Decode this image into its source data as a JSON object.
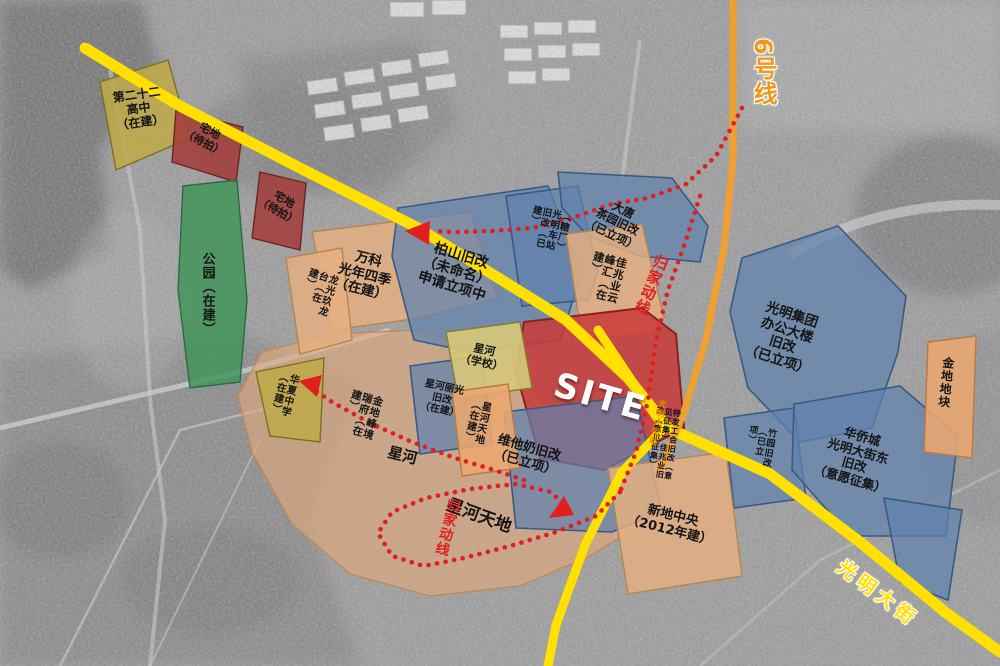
{
  "map": {
    "colors": {
      "road_yellow": "#FFE000",
      "metro_orange": "#F0A030",
      "route_red": "#E01F1F",
      "zone_blue": "#6082AF",
      "zone_tan": "#E7B080",
      "zone_green": "#409458",
      "zone_site_red": "#C93A3A"
    },
    "roads": [
      {
        "id": "main-road-west",
        "points": "85,48 180,106 300,168 418,228 492,274 566,320 628,378 668,428",
        "width": 11,
        "color": "#FFE000"
      },
      {
        "id": "guangming-street",
        "points": "668,428 770,474 860,542 945,612 1000,652",
        "width": 11,
        "color": "#FFE000"
      },
      {
        "id": "cross-road-south",
        "points": "598,330 642,396 664,428 622,472 585,545 556,625 548,666",
        "width": 9,
        "color": "#FFE000"
      }
    ],
    "metro": {
      "id": "metro-line-6",
      "points": "733,0 733,160 724,248 706,340 684,412 660,470",
      "width": 7,
      "color": "#F0A030"
    },
    "routes": [
      {
        "id": "route-home-top",
        "points": "742,108 716,156 686,184 648,198 612,204 572,218 532,228 492,231 455,232 432,231"
      },
      {
        "id": "route-home-side",
        "points": "700,196 686,240 668,290 655,345 648,400 636,452 620,492"
      },
      {
        "id": "route-home-loop",
        "points": "620,492 596,516 556,532 510,546 464,558 424,566 392,556 378,533 392,512 426,498 470,489 516,484 551,492 562,503"
      },
      {
        "id": "route-home-school",
        "points": "524,480 494,470 455,458 412,442 372,424 332,402 312,388"
      }
    ],
    "arrows": [
      {
        "id": "arrow-main-road",
        "points": "430,221 405,231 429,245"
      },
      {
        "id": "arrow-huaxia",
        "points": "322,375 299,381 317,397"
      },
      {
        "id": "arrow-weitanai",
        "points": "549,518 564,496 574,515"
      }
    ],
    "zones": [
      {
        "id": "tan-mass",
        "type": "z-tanbig",
        "points": "262,352 330,334 420,330 470,348 520,380 560,420 600,452 640,472 648,520 590,556 520,586 430,596 350,574 292,524 252,452 238,396"
      },
      {
        "id": "school-22",
        "type": "z-olive",
        "points": "100,82 168,60 190,138 116,170",
        "label": {
          "text": [
            "第二十二",
            "高中",
            "（在建）"
          ],
          "x": 112,
          "y": 92,
          "rot": -8,
          "size": 12
        }
      },
      {
        "id": "zhaidi-1",
        "type": "z-maroon",
        "points": "176,110 243,127 236,182 172,162",
        "label": {
          "text": [
            "宅地",
            "（待拍）"
          ],
          "x": 193,
          "y": 116,
          "rot": 28,
          "size": 11
        }
      },
      {
        "id": "zhaidi-2",
        "type": "z-maroon",
        "points": "260,172 306,183 300,250 252,238",
        "label": {
          "text": [
            "宅地",
            "（待拍）"
          ],
          "x": 268,
          "y": 184,
          "rot": 30,
          "size": 11
        }
      },
      {
        "id": "park",
        "type": "z-green",
        "points": "183,186 237,180 247,300 240,382 190,388 178,290",
        "label": {
          "text": [
            "公园（在建）"
          ],
          "x": 200,
          "y": 252,
          "rot": 0,
          "size": 13,
          "mode": "v",
          "h": 120
        }
      },
      {
        "id": "wanke",
        "type": "z-tan",
        "points": "312,232 470,212 498,298 420,318 332,330",
        "label": {
          "text": [
            "万科",
            "光年四季",
            "（在建）"
          ],
          "x": 344,
          "y": 246,
          "rot": 14,
          "size": 13.5
        }
      },
      {
        "id": "longguang",
        "type": "z-tan",
        "points": "286,258 342,248 352,340 300,354",
        "label": {
          "text": [
            "龙光玖龙台（在建）"
          ],
          "x": 308,
          "y": 266,
          "rot": 18,
          "size": 10,
          "mode": "v",
          "h": 46
        }
      },
      {
        "id": "baishan",
        "type": "z-blue",
        "points": "398,208 548,186 582,272 560,340 470,352 414,340 392,256",
        "label": {
          "text": [
            "柏山旧改",
            "（未命名）",
            "申请立项中"
          ],
          "x": 430,
          "y": 238,
          "rot": 17,
          "size": 14
        }
      },
      {
        "id": "tangchang",
        "type": "z-blue",
        "points": "506,196 578,186 598,272 588,300 522,306",
        "label": {
          "text": [
            "（糖厂）光明车站旧改（已建）"
          ],
          "x": 532,
          "y": 204,
          "rot": 12,
          "size": 9.5,
          "mode": "v",
          "h": 46
        }
      },
      {
        "id": "datang",
        "type": "z-blue",
        "points": "558,172 672,178 708,226 700,262 640,256 588,236 562,208",
        "label": {
          "text": [
            "大唐",
            "茶园旧改",
            "（已立项）"
          ],
          "x": 600,
          "y": 192,
          "rot": 26,
          "size": 11.5
        }
      },
      {
        "id": "jiazhaoye",
        "type": "z-tan",
        "points": "566,234 642,224 664,318 652,334 582,338",
        "label": {
          "text": [
            "佳兆业云峰汇（在建）"
          ],
          "x": 594,
          "y": 250,
          "rot": 14,
          "size": 11,
          "mode": "v",
          "h": 48
        }
      },
      {
        "id": "guangming-group",
        "type": "z-blue",
        "points": "742,258 838,226 906,296 898,352 872,428 800,442 748,388 730,312",
        "label": {
          "text": [
            "光明集团",
            "办公大楼",
            "旧改",
            "（已立项）"
          ],
          "x": 762,
          "y": 298,
          "rot": 18,
          "size": 13.5
        }
      },
      {
        "id": "zhuyuan",
        "type": "z-blue",
        "points": "724,418 794,408 806,498 734,508",
        "label": {
          "text": [
            "竹园旧改（已立项）"
          ],
          "x": 748,
          "y": 424,
          "rot": 10,
          "size": 9,
          "mode": "v",
          "h": 42
        }
      },
      {
        "id": "huaqiaocheng",
        "type": "z-blue",
        "points": "794,404 900,386 958,436 946,536 850,536 792,470",
        "label": {
          "text": [
            "华侨城",
            "光明大街东",
            "旧改",
            "（意愿征集）"
          ],
          "x": 828,
          "y": 420,
          "rot": 16,
          "size": 12.5
        }
      },
      {
        "id": "huaqiaocheng-east",
        "type": "z-blue",
        "points": "884,498 962,510 948,600 900,582"
      },
      {
        "id": "jindi-dikuai",
        "type": "z-orgs",
        "points": "928,342 976,336 972,458 924,452",
        "label": {
          "text": [
            "金地地块"
          ],
          "x": 942,
          "y": 356,
          "rot": 6,
          "size": 12,
          "mode": "v",
          "h": 90
        }
      },
      {
        "id": "site",
        "type": "z-red",
        "points": "524,322 642,308 676,334 684,428 604,470 540,458 516,372",
        "label": {
          "text": [
            "SITE"
          ],
          "x": 560,
          "y": 366,
          "rot": 16,
          "size": 34,
          "color": "#ffffff",
          "cls": "site-t"
        }
      },
      {
        "id": "weitanai",
        "type": "z-blue",
        "points": "504,412 636,396 662,512 612,532 516,528",
        "label": {
          "text": [
            "维他奶旧改",
            "（已立项）"
          ],
          "x": 500,
          "y": 432,
          "rot": 16,
          "size": 13
        }
      },
      {
        "id": "xinghe-liguang",
        "type": "z-blue",
        "points": "410,366 482,356 492,444 420,454",
        "label": {
          "text": [
            "星河丽光",
            "旧改",
            "（在建）"
          ],
          "x": 426,
          "y": 378,
          "rot": 12,
          "size": 10
        }
      },
      {
        "id": "xinghe-school",
        "type": "z-khaki",
        "points": "446,332 520,322 532,388 458,398",
        "label": {
          "text": [
            "星河",
            "（学校）"
          ],
          "x": 464,
          "y": 340,
          "rot": 12,
          "size": 11
        }
      },
      {
        "id": "xinghe-tiandi-blk",
        "type": "z-orgs",
        "points": "452,392 508,384 520,468 462,476",
        "label": {
          "text": [
            "星河天地（在建）"
          ],
          "x": 470,
          "y": 398,
          "rot": 12,
          "size": 10,
          "mode": "v",
          "h": 44
        }
      },
      {
        "id": "huaxia",
        "type": "z-olive",
        "points": "256,372 324,358 320,442 270,436",
        "label": {
          "text": [
            "华夏中学（在建）"
          ],
          "x": 278,
          "y": 370,
          "rot": 14,
          "size": 10,
          "mode": "v",
          "h": 44
        }
      },
      {
        "id": "xindi-zhongyang",
        "type": "z-tan",
        "points": "608,468 726,452 742,576 628,594",
        "label": {
          "text": [
            "新地中央",
            "（2012年建）"
          ],
          "x": 632,
          "y": 498,
          "rot": 14,
          "size": 13
        }
      }
    ],
    "labels": [
      {
        "id": "jindi-fengjing",
        "text": [
          "金地峰境瑞府（在建）"
        ],
        "x": 352,
        "y": 388,
        "rot": 16,
        "size": 10.5,
        "mode": "v",
        "h": 48
      },
      {
        "id": "xinghe-big",
        "text": [
          "星河"
        ],
        "x": 390,
        "y": 444,
        "rot": 14,
        "size": 15
      },
      {
        "id": "xinghe-tiandi-big",
        "text": [
          "星河天地"
        ],
        "x": 450,
        "y": 496,
        "rot": 20,
        "size": 17
      },
      {
        "id": "gonghui-tiny",
        "text": [
          "特发工会旧改（意见征集）佳兆业旧改（意见征集）"
        ],
        "x": 656,
        "y": 406,
        "rot": 8,
        "size": 8,
        "mode": "v",
        "h": 78,
        "color": "#101020"
      },
      {
        "id": "guijia-top",
        "text": [
          "归家动线"
        ],
        "x": 655,
        "y": 252,
        "rot": 22,
        "size": 15,
        "mode": "v",
        "h": 80,
        "color": "#E01F1F"
      },
      {
        "id": "guijia-bottom",
        "text": [
          "归家动线"
        ],
        "x": 447,
        "y": 496,
        "rot": 14,
        "size": 14,
        "mode": "v",
        "h": 76,
        "color": "#E01F1F"
      },
      {
        "id": "metro-line6-label",
        "text": [
          "6号线"
        ],
        "x": 750,
        "y": 38,
        "rot": 0,
        "size": 24,
        "mode": "v",
        "h": 120,
        "color": "#F09818",
        "cls": "outline-w"
      },
      {
        "id": "guangming-street-label",
        "text": [
          "光明大街"
        ],
        "x": 846,
        "y": 556,
        "rot": 37,
        "size": 19,
        "color": "#FFE000",
        "cls": "outline-w",
        "ls": 5
      },
      {
        "id": "station-label",
        "text": [
          "光明大街站"
        ],
        "x": 658,
        "y": 398,
        "rot": 14,
        "size": 8.5,
        "mode": "v",
        "h": 64,
        "color": "#E08A00"
      }
    ]
  }
}
